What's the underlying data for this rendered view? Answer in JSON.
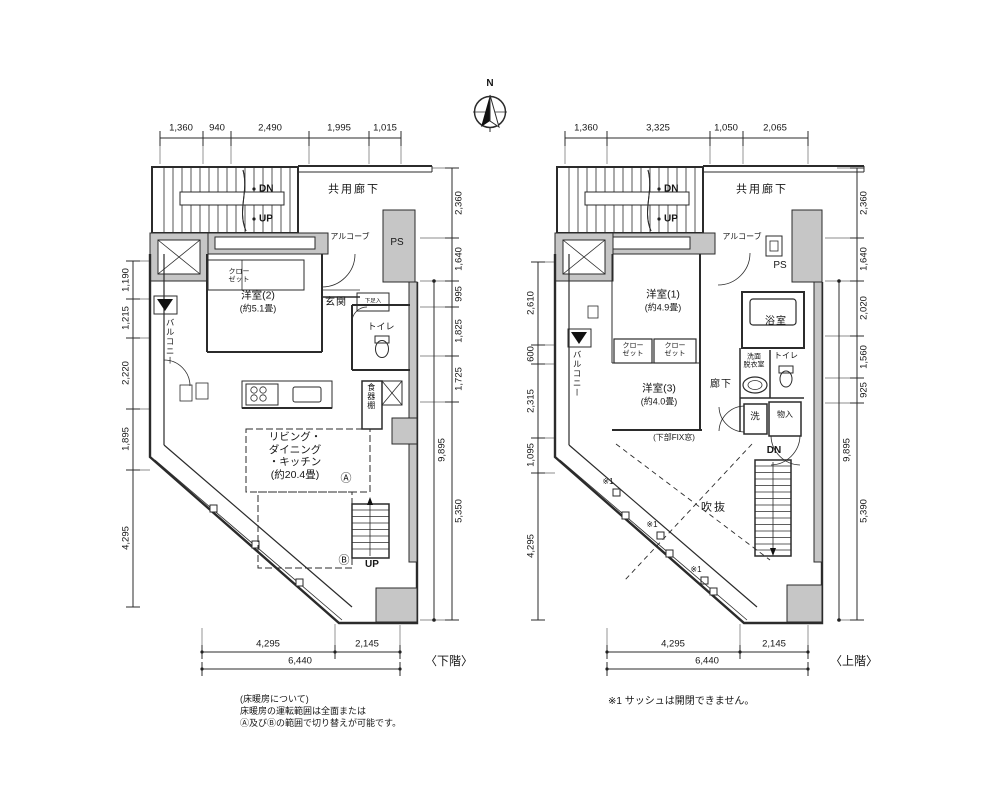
{
  "compass": {
    "north": "N"
  },
  "lower": {
    "floor_label": "〈下階〉",
    "dims": {
      "top": [
        "1,360",
        "940",
        "2,490",
        "1,995",
        "1,015"
      ],
      "left": [
        "1,190",
        "1,215",
        "2,220",
        "1,895",
        "4,295"
      ],
      "right": [
        "2,360",
        "1,640",
        "995",
        "1,825",
        "1,725",
        "5,350"
      ],
      "right_total": "9,895",
      "bottom": [
        "4,295",
        "2,145"
      ],
      "bottom_total": "6,440"
    },
    "labels": {
      "corridor": "共用廊下",
      "dn": "DN",
      "up": "UP",
      "alcove": "アルコーブ",
      "ps": "PS",
      "closet": "クロー\nゼット",
      "room2_name": "洋室(2)",
      "room2_size": "(約5.1畳)",
      "entrance": "玄関",
      "shoe_box": "下足入",
      "toilet": "トイレ",
      "balcony": "バルコニー",
      "cupboard": "食器棚",
      "ldk": "リビング・\nダイニング\n・キッチン\n(約20.4畳)",
      "zone_a": "Ⓐ",
      "zone_b": "Ⓑ",
      "stair_up": "UP"
    },
    "notes": [
      "(床暖房について)",
      "床暖房の運転範囲は全面または",
      "Ⓐ及びⒷの範囲で切り替えが可能です。"
    ]
  },
  "upper": {
    "floor_label": "〈上階〉",
    "dims": {
      "top": [
        "1,360",
        "3,325",
        "1,050",
        "2,065"
      ],
      "left": [
        "2,610",
        "600",
        "2,315",
        "1,095",
        "4,295"
      ],
      "right": [
        "2,360",
        "1,640",
        "2,020",
        "1,560",
        "925",
        "5,390"
      ],
      "right_total": "9,895",
      "bottom": [
        "4,295",
        "2,145"
      ],
      "bottom_total": "6,440"
    },
    "labels": {
      "corridor": "共用廊下",
      "dn": "DN",
      "up": "UP",
      "alcove": "アルコーブ",
      "ps": "PS",
      "room1_name": "洋室(1)",
      "room1_size": "(約4.9畳)",
      "bath": "浴室",
      "closet1": "クロー\nゼット",
      "closet2": "クロー\nゼット",
      "room3_name": "洋室(3)",
      "room3_size": "(約4.0畳)",
      "hallway": "廊下",
      "washroom": "洗面\n脱衣室",
      "toilet": "トイレ",
      "washer": "洗",
      "storage": "物入",
      "balcony": "バルコニー",
      "fix_window": "(下部FIX窓)",
      "void": "吹抜",
      "stair_dn": "DN",
      "sash1": "※1",
      "sash2": "※1",
      "sash3": "※1"
    },
    "note": "※1 サッシュは開閉できません。"
  }
}
